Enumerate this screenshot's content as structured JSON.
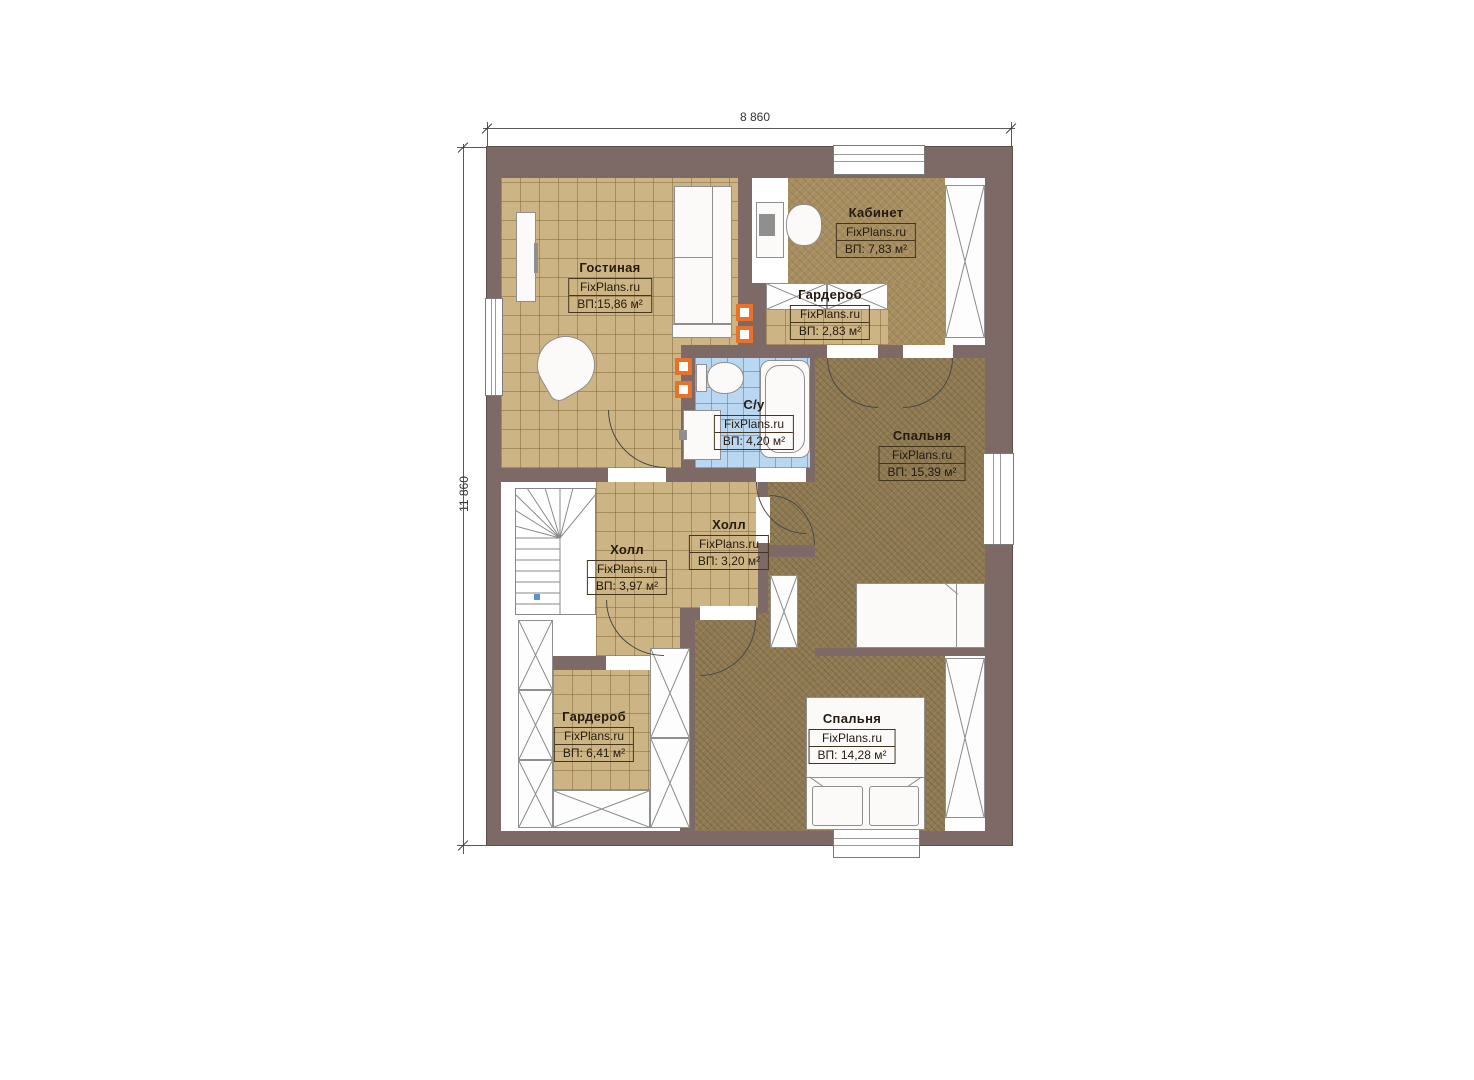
{
  "dimensions": {
    "width_label": "8 860",
    "height_label": "11 860"
  },
  "rooms": [
    {
      "name": "Гостиная",
      "brand": "FixPlans.ru",
      "area": "ВП:15,86 м²"
    },
    {
      "name": "Кабинет",
      "brand": "FixPlans.ru",
      "area": "ВП: 7,83 м²"
    },
    {
      "name": "Гардероб",
      "brand": "FixPlans.ru",
      "area": "ВП: 2,83 м²"
    },
    {
      "name": "С/у",
      "brand": "FixPlans.ru",
      "area": "ВП: 4,20 м²"
    },
    {
      "name": "Спальня",
      "brand": "FixPlans.ru",
      "area": "ВП: 15,39 м²"
    },
    {
      "name": "Холл",
      "brand": "FixPlans.ru",
      "area": "ВП: 3,20 м²"
    },
    {
      "name": "Холл",
      "brand": "FixPlans.ru",
      "area": "ВП: 3,97 м²"
    },
    {
      "name": "Гардероб",
      "brand": "FixPlans.ru",
      "area": "ВП: 6,41 м²"
    },
    {
      "name": "Спальня",
      "brand": "FixPlans.ru",
      "area": "ВП: 14,28 м²"
    }
  ],
  "colors": {
    "wall": "#7d6a66",
    "tile_floor": "#cdb484",
    "office_floor": "#a68d5f",
    "carpet_floor": "#8e7952",
    "bathroom_floor": "#bad7f2",
    "vent_accent": "#e8722c"
  }
}
